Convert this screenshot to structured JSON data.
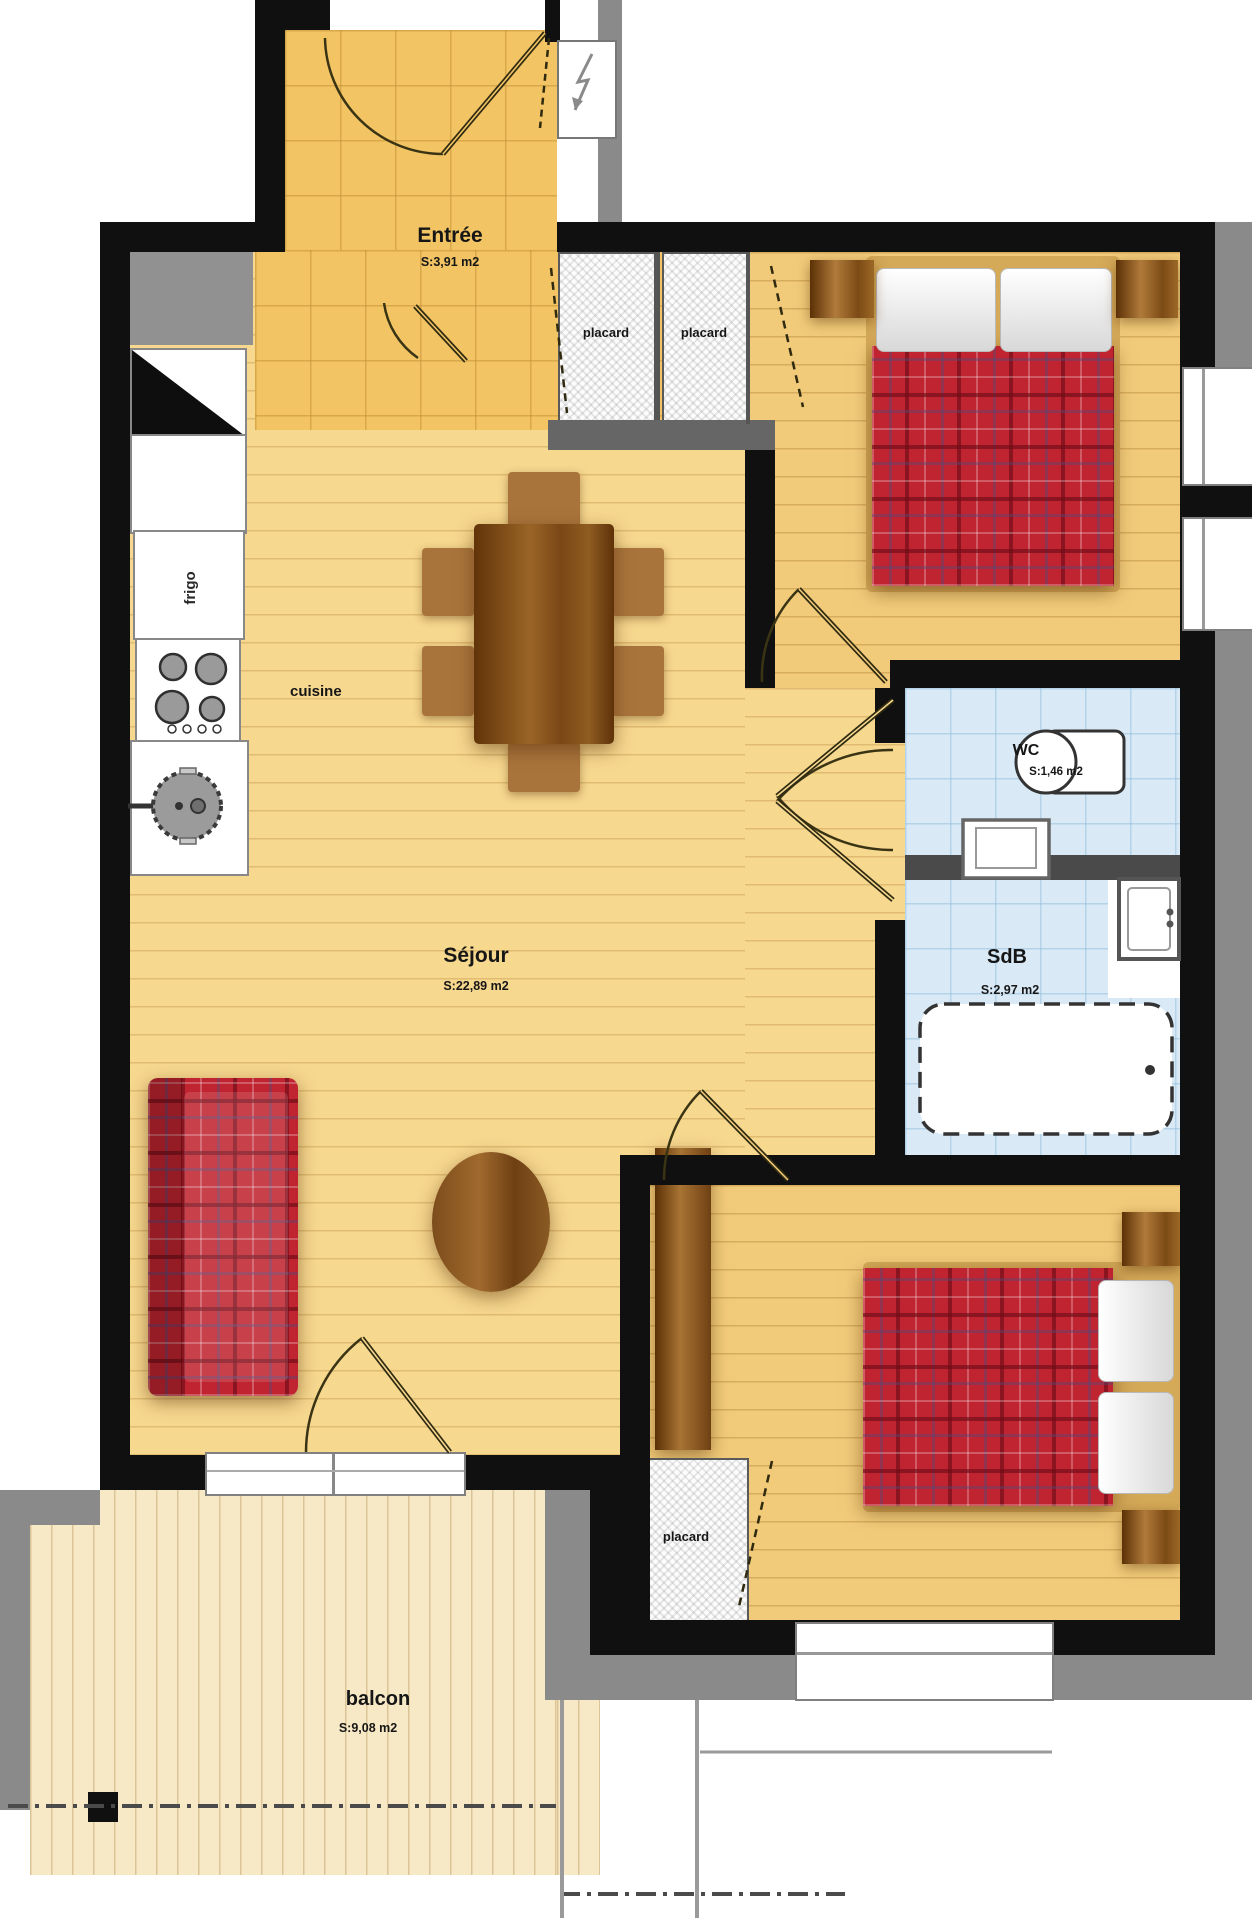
{
  "plan": {
    "rooms": {
      "entree": {
        "name": "Entrée",
        "area": "S:3,91 m2"
      },
      "sejour": {
        "name": "Séjour",
        "area": "S:22,89 m2"
      },
      "wc": {
        "name": "WC",
        "area": "S:1,46 m2"
      },
      "sdb": {
        "name": "SdB",
        "area": "S:2,97 m2"
      },
      "balcon": {
        "name": "balcon",
        "area": "S:9,08 m2"
      }
    },
    "fixtures": {
      "cuisine": "cuisine",
      "frigo": "frigo",
      "placard": "placard"
    },
    "colors": {
      "wall": "#111111",
      "trim_gray": "#8a8a8a",
      "living_floor": "#f7d88f",
      "bedroom_floor": "#f2cb7a",
      "entry_tile": "#f2c464",
      "bath_tile": "#d9eaf6",
      "balcony_floor": "#f8e9c6",
      "plaid_red": "#bf2430",
      "furniture_wood": "#8a5a24"
    }
  }
}
